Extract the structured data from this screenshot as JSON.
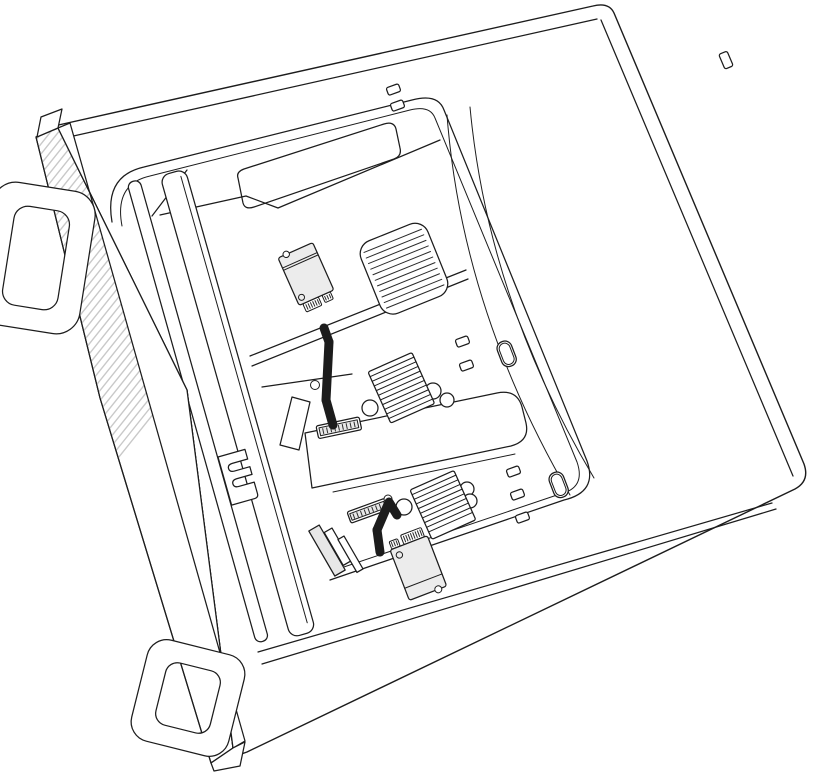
{
  "illustration": {
    "description": "Line-art illustration of a Mac Pro tower lying on its side with the housing removed, viewed from above at an angle. Two blue arrows show one SSD module lifted up and away from the SSD connector near the top of the logic board, and a second SSD module being removed downward from the connector near the bottom.",
    "device": "Mac Pro",
    "orientation": "lying on its side",
    "components": {
      "front_panel": "lattice (cheese-grater) front panel",
      "top_handle": "handle loop",
      "bottom_foot": "foot loop",
      "air_funnel": "internal air guide funnel",
      "vent_grille": "angled vent grille",
      "heatsinks": "two finned heatsink stacks",
      "memory_cover": "central memory cover bar",
      "ssd_connector_top": "upper SSD connector",
      "ssd_connector_bottom": "lower SSD connector",
      "ssd_module_top": "removed SSD module (upper)",
      "ssd_module_bottom": "SSD module being removed (lower)",
      "latch_slots": "two oval latch slots",
      "notch_bracket": "retention bracket with two notches"
    },
    "arrows": [
      {
        "id": "removal-arrow-top",
        "direction": "up-left, out of upper SSD slot"
      },
      {
        "id": "removal-arrow-bottom",
        "direction": "down-right, out of lower SSD slot"
      }
    ]
  },
  "colors": {
    "background": "#ffffff",
    "line": "#1c1c1c",
    "lattice_hatch": "#c9c9c9",
    "module_fill": "#ececec",
    "cover_fill": "#e7e7e7",
    "arrow_primary": "#1b72f1",
    "arrow_secondary": "#8fbdf8"
  }
}
